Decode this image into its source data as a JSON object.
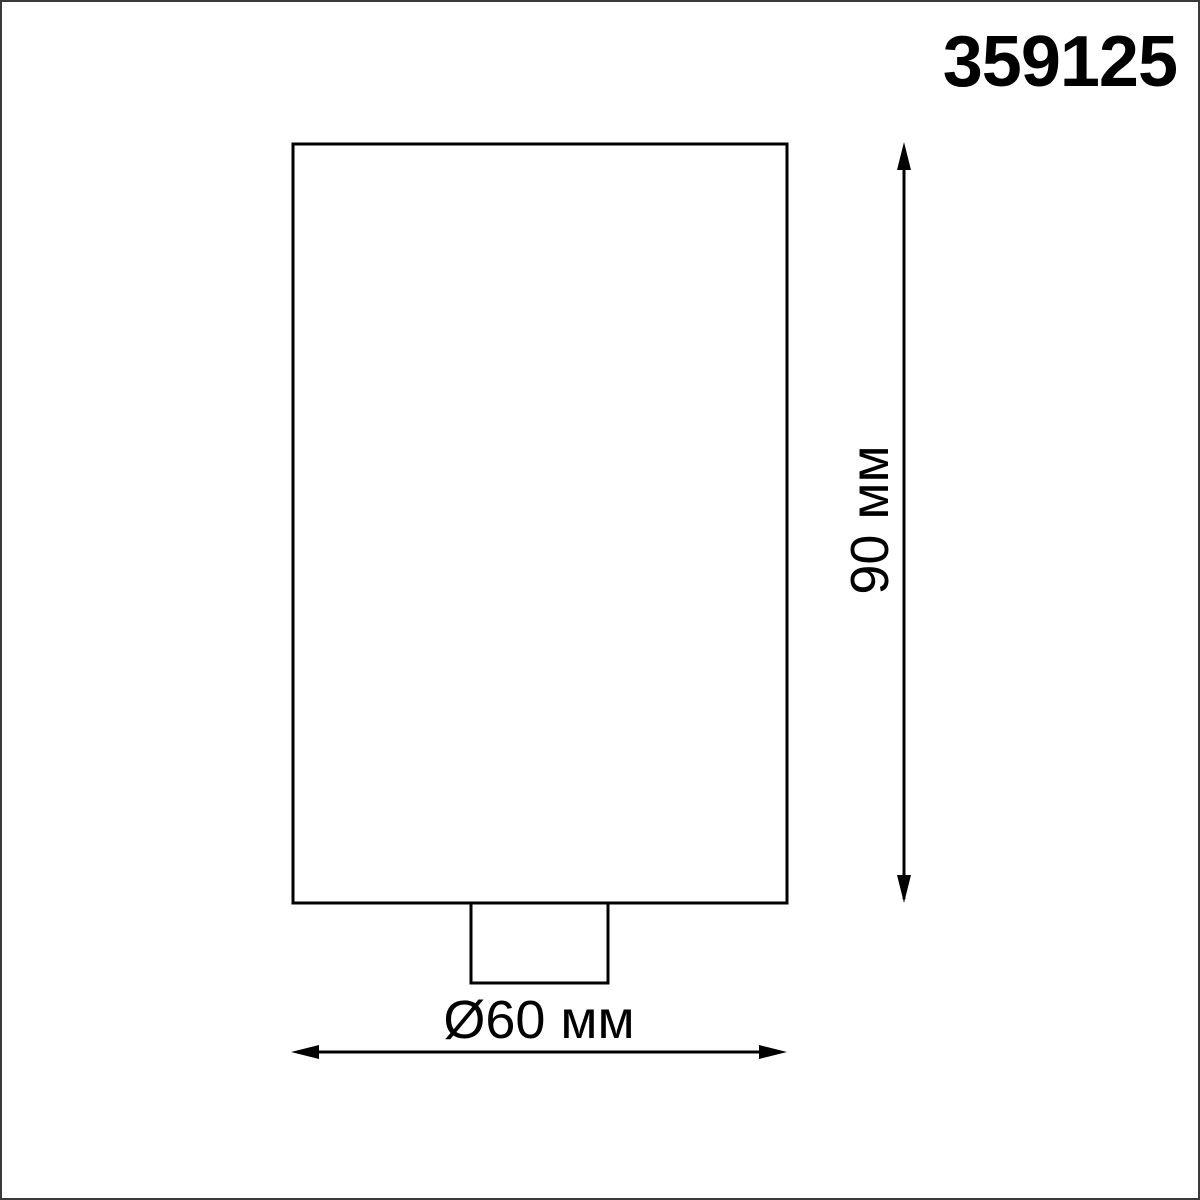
{
  "page": {
    "background": "#ffffff",
    "border_color": "#3a3a3a",
    "line_color": "#000000",
    "text_color": "#000000"
  },
  "drawing": {
    "product_code": "359125",
    "height_label": "90 мм",
    "diameter_label": "Ø60 мм"
  }
}
